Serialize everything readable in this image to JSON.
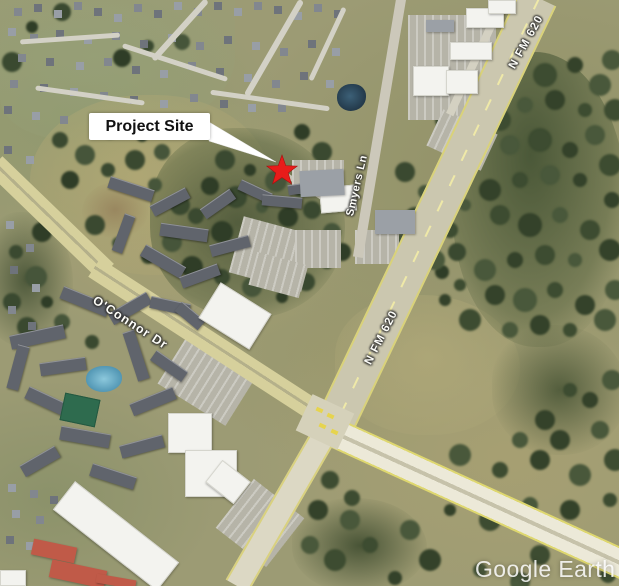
{
  "map": {
    "type": "satellite-aerial",
    "provider_watermark": "Google Earth",
    "callout": {
      "label": "Project Site"
    },
    "marker": {
      "shape": "star",
      "color": "#e81c1a"
    },
    "road_labels": {
      "oconnor": "O'Connor Dr",
      "fm620_north": "N FM 620",
      "fm620_mid": "N FM 620",
      "smyers": "Smyers Ln"
    }
  }
}
